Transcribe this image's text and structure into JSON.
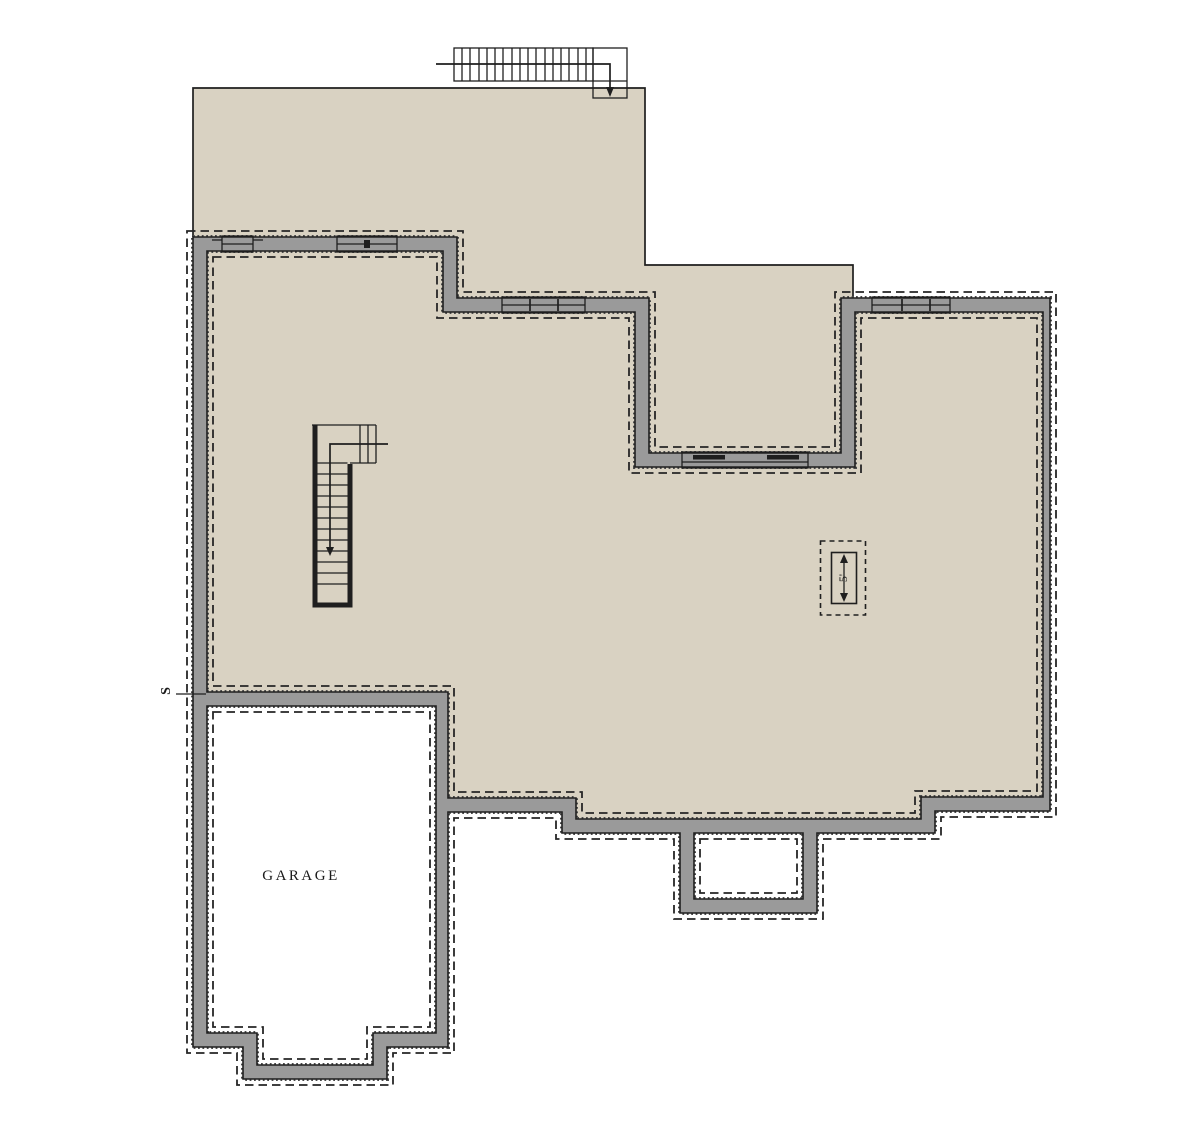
{
  "labels": {
    "garage": "GARAGE",
    "stair_width_dimension": "5'",
    "side_marker": "S"
  },
  "colors": {
    "background": "#ffffff",
    "floor": "#d9d2c2",
    "wall": "#9a9a9a",
    "line": "#1f1f1f",
    "unexcavated": "#ffffff"
  }
}
